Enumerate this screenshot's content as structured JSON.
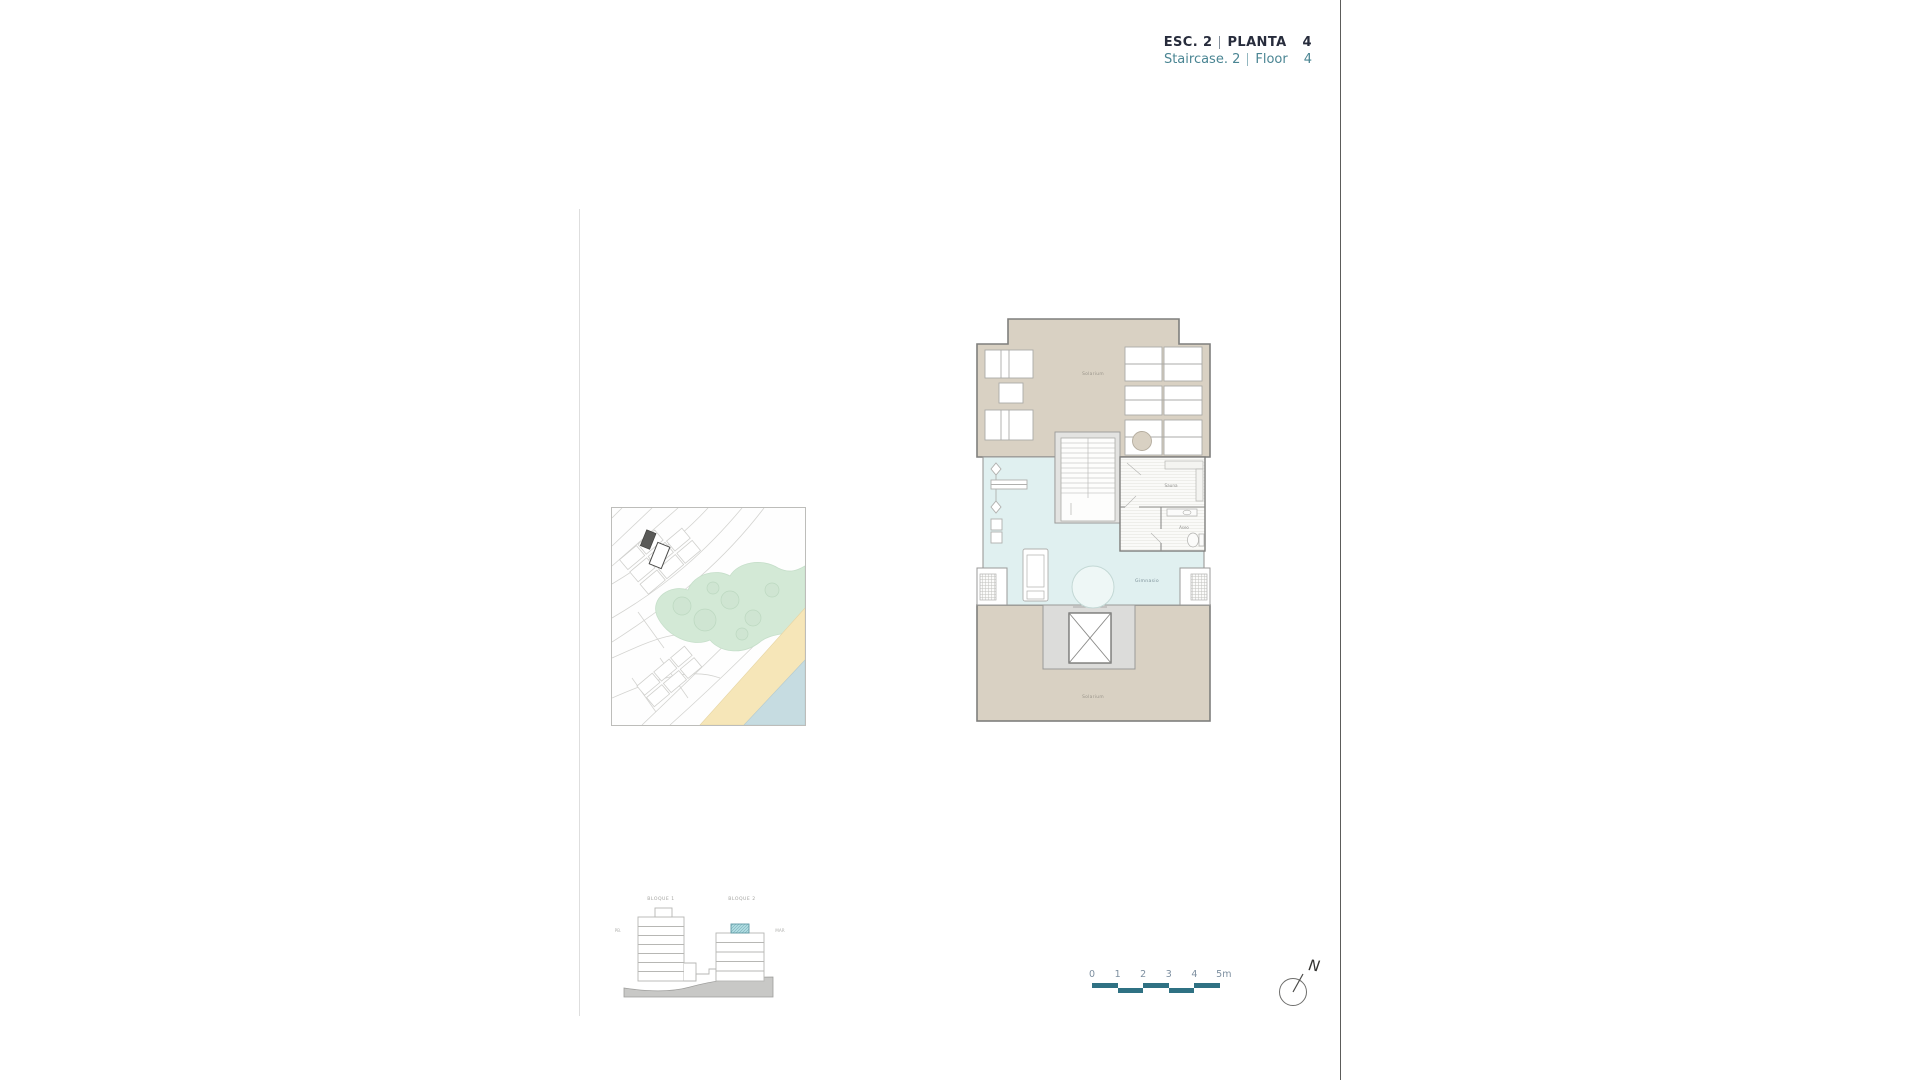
{
  "header": {
    "esc_label": "ESC. 2",
    "planta_label": "PLANTA",
    "planta_number": "4",
    "staircase_label": "Staircase. 2",
    "floor_label": "Floor",
    "floor_number": "4",
    "accent_color": "#4a8593"
  },
  "floor_plan": {
    "labels": {
      "solarium_top": "Solarium",
      "sauna": "Sauna",
      "toilet": "Aseo",
      "gym": "Gimnasio",
      "solarium_bottom": "Solarium"
    },
    "colors": {
      "terrace_tan": "#d9d1c3",
      "gym_floor_cyan": "#e0f0f0",
      "walls_grey": "#7f7f7d",
      "core_grey": "#dcdcda"
    }
  },
  "site_map": {
    "colors": {
      "park_green": "#d3e9d6",
      "beach_sand": "#f6e6b8",
      "sea_blue": "#c6dce1",
      "building_marker": "#5a5a58"
    }
  },
  "elevation": {
    "block1_label": "BLOQUE 1",
    "block2_label": "BLOQUE 2",
    "left_label": "PB.",
    "right_label": "MAR",
    "highlight_color": "#aedbe0"
  },
  "scale_bar": {
    "ticks": [
      "0",
      "1",
      "2",
      "3",
      "4",
      "5m"
    ],
    "bar_color": "#2f7183"
  },
  "north_arrow": {
    "label": "N"
  }
}
